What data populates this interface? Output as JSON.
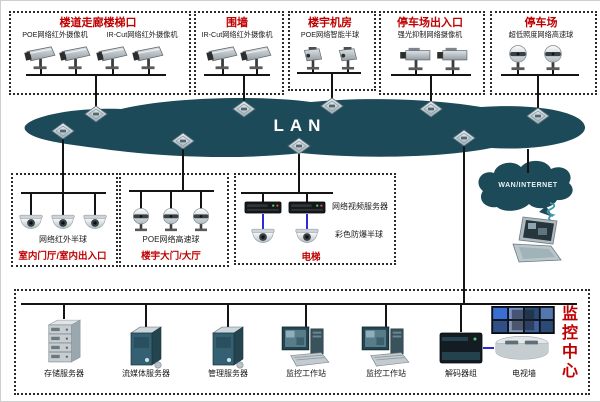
{
  "network": {
    "lan_label": "LAN",
    "wan_label": "WAN/INTERNET"
  },
  "colors": {
    "cloud_teal": "#1d4a59",
    "title_red": "#c00000",
    "wire_black": "#141414",
    "wire_blue": "#2b2bd5"
  },
  "icons": {
    "lan_switch": "diamond-switch-icon",
    "camera_types": [
      "bullet-camera",
      "ptz-camera",
      "box-camera",
      "speed-dome",
      "mini-dome"
    ],
    "wan_link": "wireless-coil-icon"
  },
  "top_zones": [
    {
      "title": "楼道走廊楼梯口",
      "labels": [
        "POE网络红外摄像机",
        "IR-Cut网络红外摄像机"
      ],
      "camera_count": 4
    },
    {
      "title": "围墙",
      "labels": [
        "IR-Cut网络红外摄像机"
      ],
      "camera_count": 2
    },
    {
      "title": "楼宇机房",
      "labels": [
        "POE网络智能半球"
      ],
      "camera_count": 2
    },
    {
      "title": "停车场出入口",
      "labels": [
        "强光抑制网络摄像机"
      ],
      "camera_count": 2
    },
    {
      "title": "停车场",
      "labels": [
        "超低照度网络高速球"
      ],
      "camera_count": 2
    }
  ],
  "mid_zones": [
    {
      "title": "室内门厅/室内出入口",
      "labels": [
        "网络红外半球"
      ],
      "camera_count": 3
    },
    {
      "title": "楼宇大门/大厅",
      "labels": [
        "POE网络高速球"
      ],
      "camera_count": 3
    },
    {
      "title": "电梯",
      "labels": [
        "网络视频服务器",
        "彩色防爆半球"
      ],
      "camera_count": 2
    }
  ],
  "bottom": {
    "title": "监控中心",
    "devices": [
      "存储服务器",
      "流媒体服务器",
      "管理服务器",
      "监控工作站",
      "监控工作站",
      "解码器组",
      "电视墙"
    ]
  }
}
